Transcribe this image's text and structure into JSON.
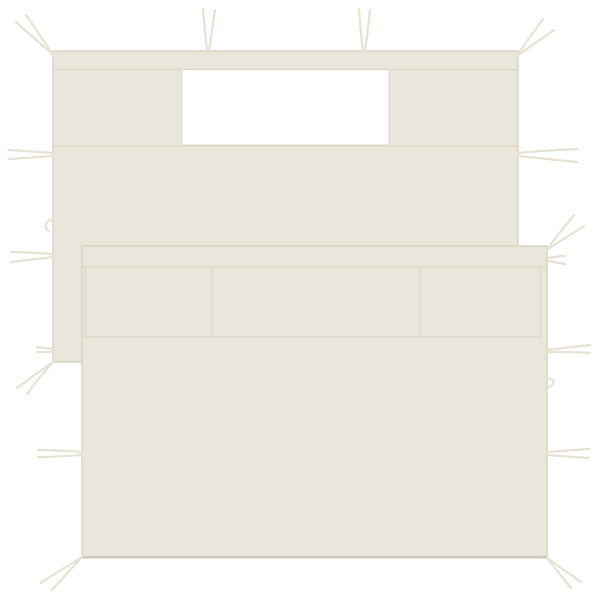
{
  "scene": {
    "description": "Two overlapping cream-colored gazebo sidewall panels with windows and attachment tie strings on a plain white background",
    "item_count": 2,
    "items": [
      {
        "label": "back sidewall panel",
        "features": [
          "top hem seam",
          "rectangular white window opening",
          "seam under window",
          "tie strings on top, left and right edges",
          "corner tie strings"
        ]
      },
      {
        "label": "front sidewall panel",
        "features": [
          "top hem seam",
          "three-section rolled window band",
          "tie strings on left and right edges",
          "corner tie strings at bottom"
        ]
      }
    ]
  },
  "colors": {
    "background": "#FFFFFF",
    "fabric": "#E9E7DB",
    "fabric_edge": "#D6D3C1",
    "seam": "#DBD8C8",
    "window": "#FFFFFF",
    "string": "#E6E3D4",
    "bottom_shadow": "#CCC9B6"
  }
}
